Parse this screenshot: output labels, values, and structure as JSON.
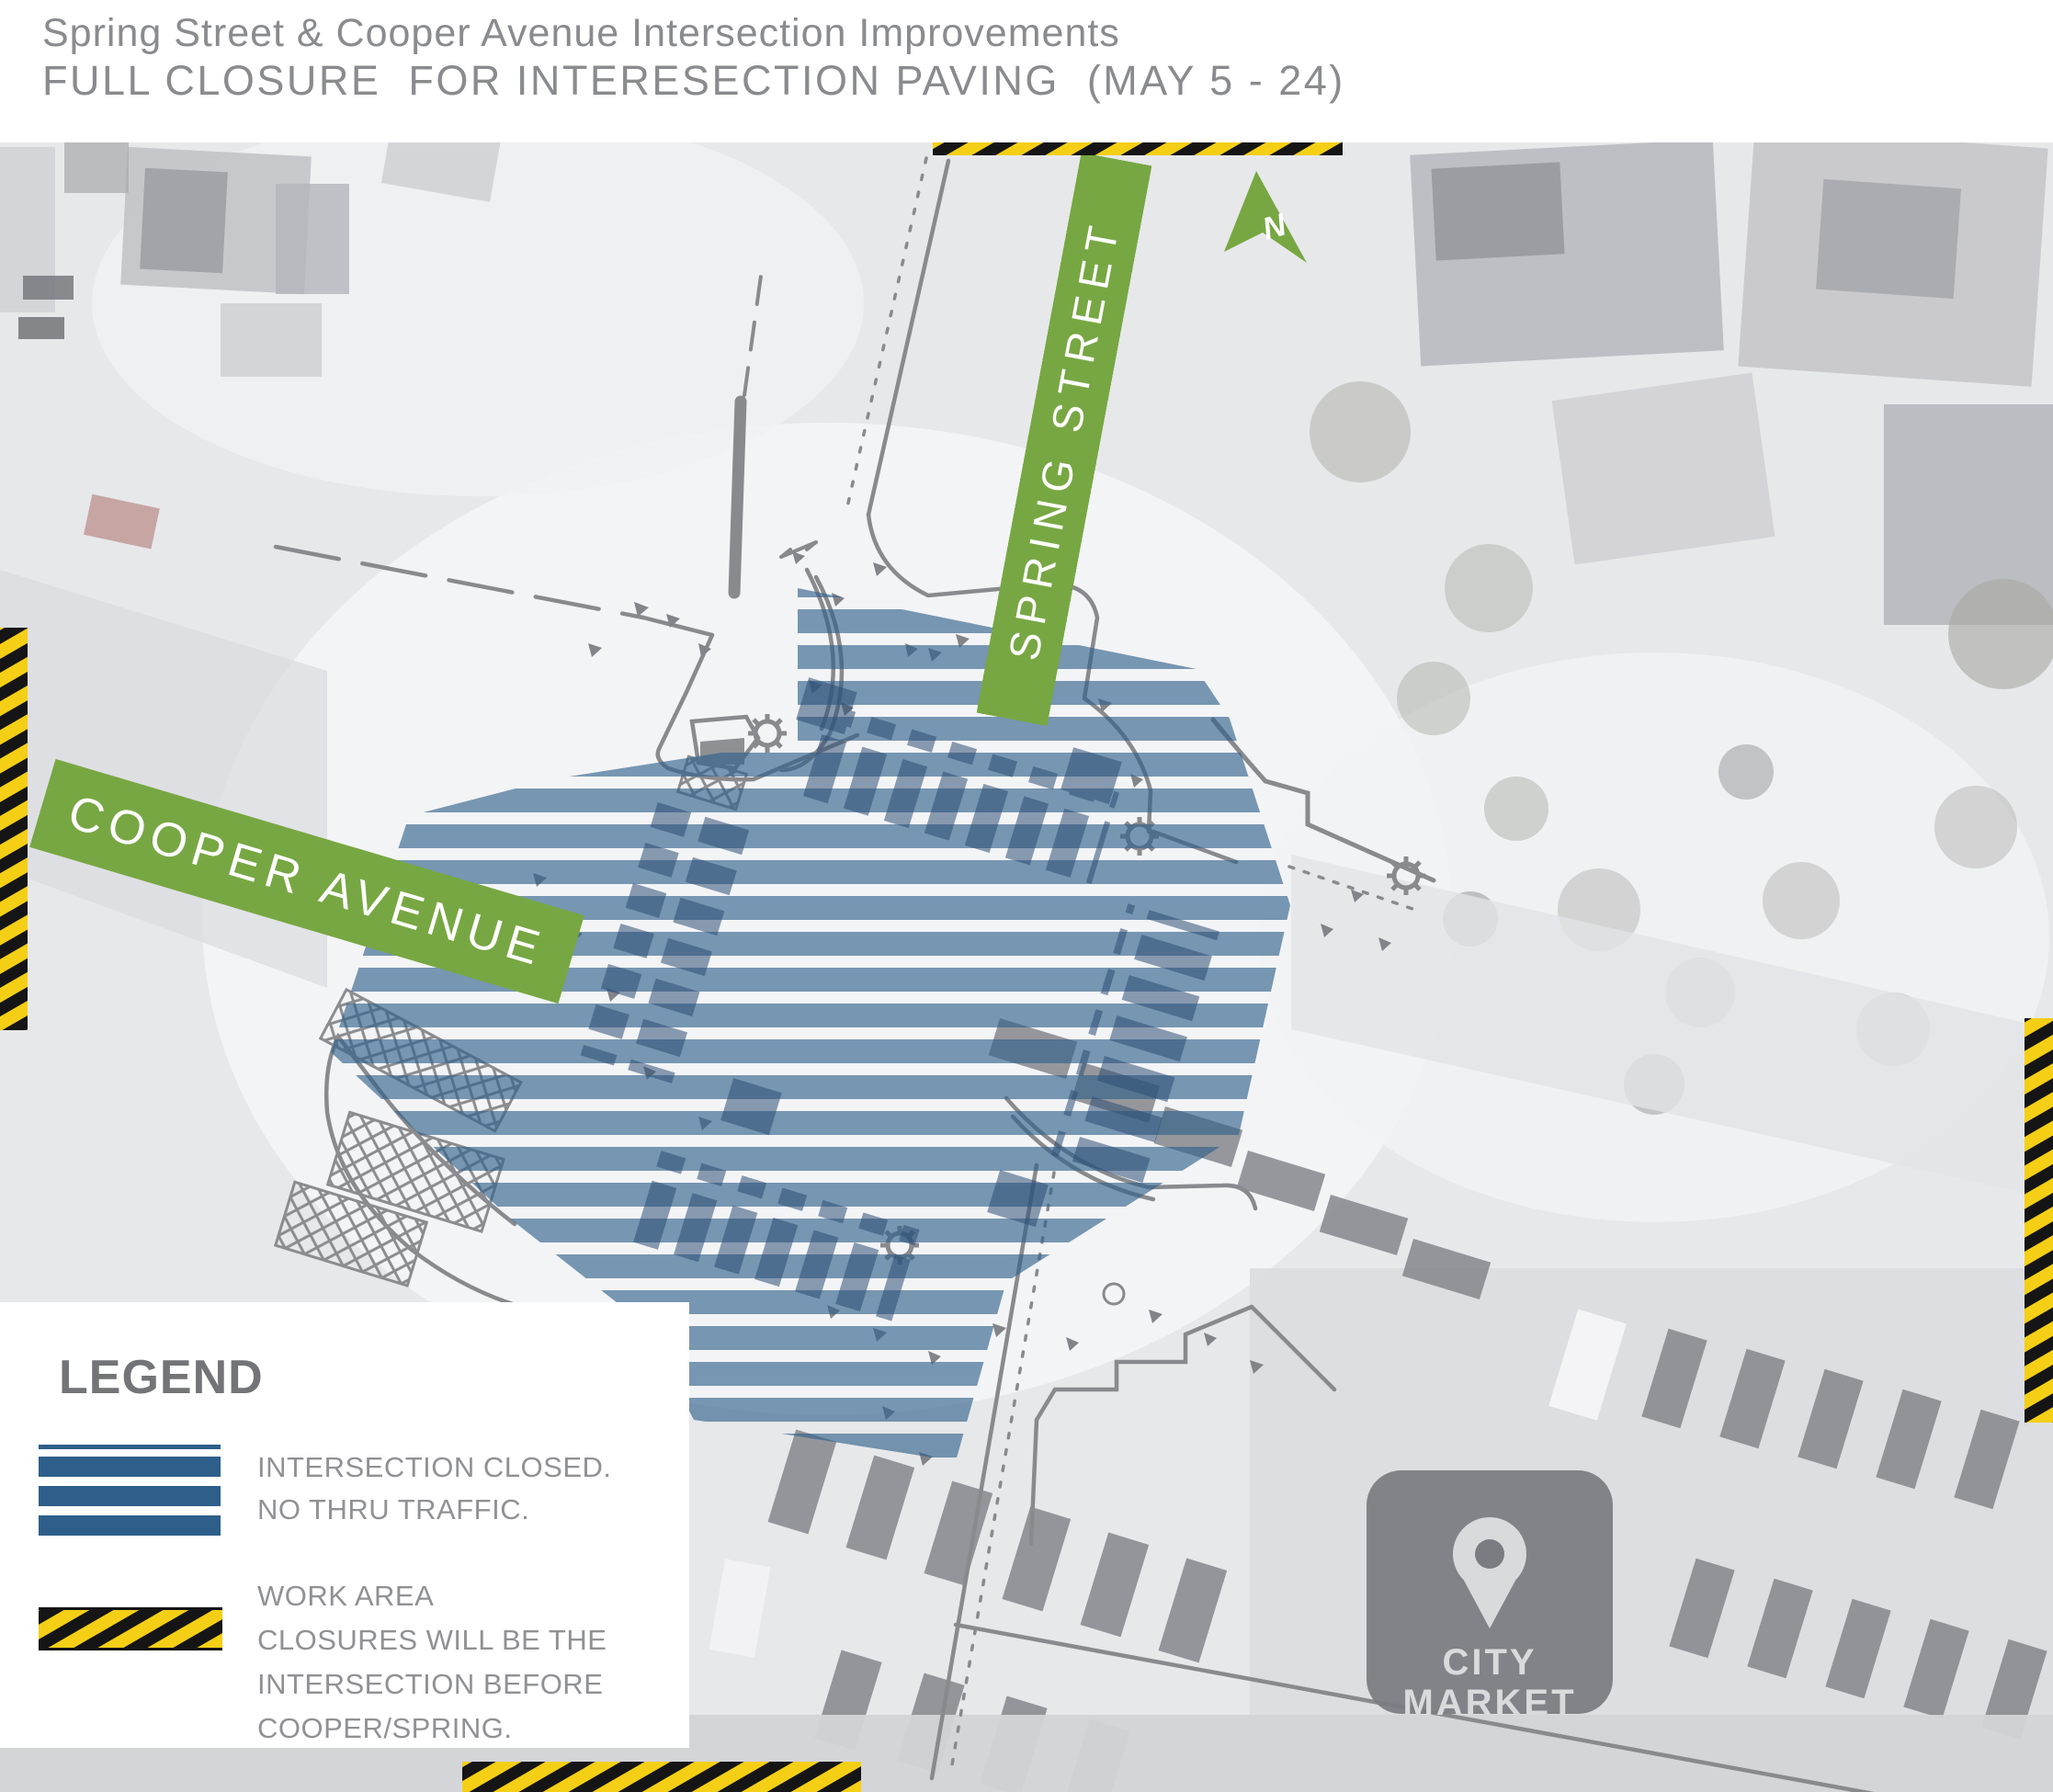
{
  "header": {
    "title_line1": "Spring Street & Cooper Avenue Intersection Improvements",
    "title_line2": "FULL CLOSURE  FOR INTERESECTION PAVING  (MAY 5 - 24)"
  },
  "map": {
    "spring_street_label": "SPRING STREET",
    "cooper_avenue_label": "COOPER AVENUE",
    "north_label": "N",
    "city_market_line1": "CITY",
    "city_market_line2": "MARKET"
  },
  "legend": {
    "heading": "LEGEND",
    "items": [
      {
        "symbol": "blue-stripes",
        "lines": [
          "INTERSECTION CLOSED.",
          "NO THRU TRAFFIC."
        ]
      },
      {
        "symbol": "hazard-tape",
        "lines": [
          "WORK AREA",
          "CLOSURES WILL BE THE",
          "INTERSECTION BEFORE",
          "COOPER/SPRING."
        ]
      }
    ]
  },
  "colors": {
    "closure_blue": "#2E5F8A",
    "banner_green": "#77A742",
    "hazard_yellow": "#F4CF15",
    "hazard_black": "#151515",
    "poi_gray": "#7B7C82",
    "title_gray": "#8A8B8E",
    "legend_heading_gray": "#737477",
    "legend_text_gray": "#909194",
    "linework_gray": "#898A8E"
  }
}
